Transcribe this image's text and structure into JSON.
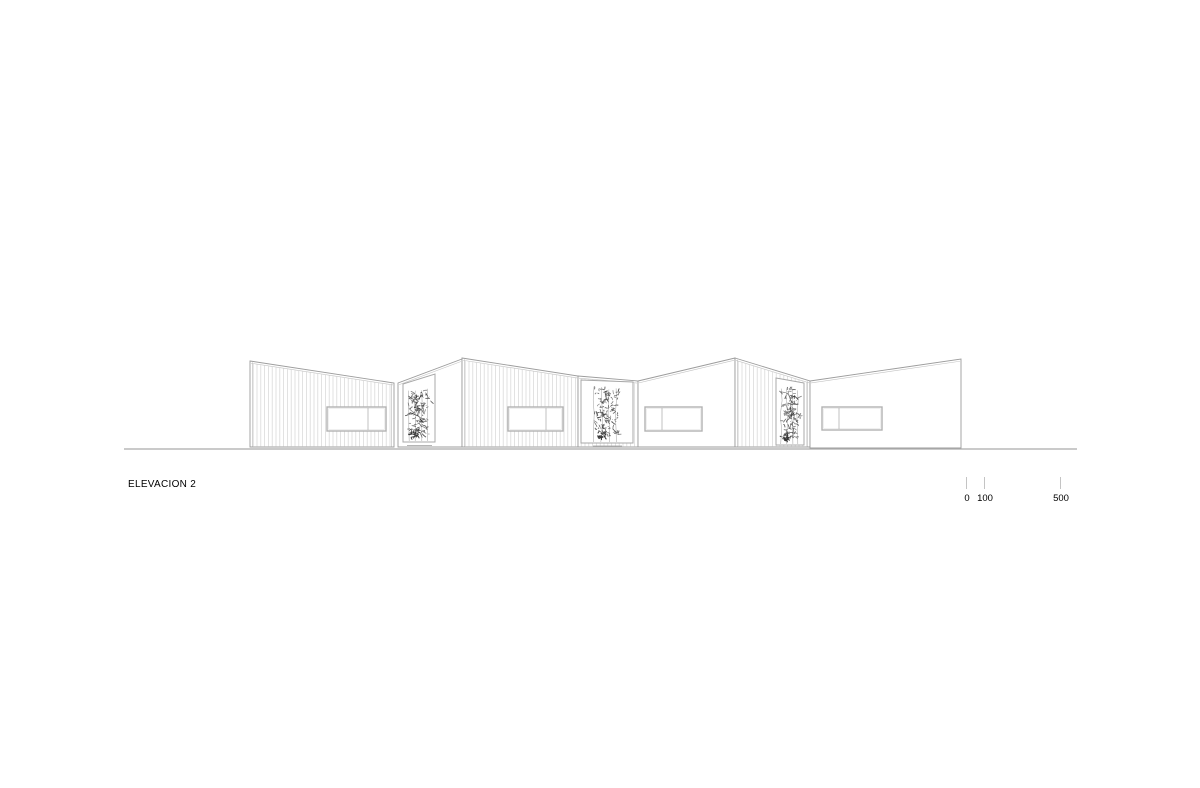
{
  "title": {
    "text": "ELEVACION 2"
  },
  "scale_bar": {
    "ticks": [
      {
        "x": 966,
        "label": "0"
      },
      {
        "x": 984,
        "label": "100"
      },
      {
        "x": 1060,
        "label": "500"
      }
    ],
    "tick_top": 477,
    "tick_height": 12,
    "label_top": 493
  },
  "colors": {
    "background": "#ffffff",
    "outline": "#9c9c9c",
    "outline_light": "#c2c2c2",
    "hatch": "#d8d8d8",
    "ground": "#ababab",
    "window_stroke": "#b2b2b2",
    "frame_stroke": "#a8a8a8",
    "plant_dark": "#353535",
    "plant_mid": "#5c5c5c",
    "plant_stem": "#a6a6a6",
    "text": "#000000"
  },
  "drawing": {
    "ground": {
      "x1": 124,
      "x2": 1077,
      "y": 449
    },
    "facades": [
      {
        "name": "facade-module-a",
        "pts": [
          [
            250,
            361
          ],
          [
            394,
            383
          ],
          [
            394,
            447
          ],
          [
            250,
            447
          ]
        ],
        "hatch": true,
        "trims": [
          "left",
          "right"
        ]
      },
      {
        "name": "facade-bay-a-wall",
        "pts": [
          [
            398,
            383
          ],
          [
            462,
            359
          ],
          [
            462,
            447
          ],
          [
            398,
            447
          ]
        ],
        "hatch": false,
        "trims": []
      },
      {
        "name": "facade-module-b",
        "pts": [
          [
            462,
            358
          ],
          [
            578,
            376
          ],
          [
            578,
            447
          ],
          [
            462,
            447
          ]
        ],
        "hatch": true,
        "trims": [
          "left"
        ]
      },
      {
        "name": "facade-bay-b-wall",
        "pts": [
          [
            578,
            376
          ],
          [
            638,
            381
          ],
          [
            638,
            447
          ],
          [
            578,
            447
          ]
        ],
        "hatch": true,
        "trims": []
      },
      {
        "name": "facade-module-c",
        "pts": [
          [
            638,
            381
          ],
          [
            735,
            358
          ],
          [
            735,
            447
          ],
          [
            638,
            447
          ]
        ],
        "hatch": false,
        "trims": []
      },
      {
        "name": "facade-module-c-hatch",
        "pts": [
          [
            735,
            358
          ],
          [
            810,
            381
          ],
          [
            810,
            447
          ],
          [
            735,
            447
          ]
        ],
        "hatch": true,
        "trims": [
          "left",
          "right"
        ]
      },
      {
        "name": "facade-module-d",
        "pts": [
          [
            810,
            381
          ],
          [
            961,
            359
          ],
          [
            961,
            448
          ],
          [
            810,
            448
          ]
        ],
        "hatch": false,
        "trims": []
      }
    ],
    "windows": [
      {
        "x": 327,
        "y": 407,
        "w": 59,
        "h": 24,
        "divider_x": 368
      },
      {
        "x": 508,
        "y": 407,
        "w": 55,
        "h": 24,
        "divider_x": 546
      },
      {
        "x": 645,
        "y": 407,
        "w": 57,
        "h": 24,
        "divider_x": 662
      },
      {
        "x": 822,
        "y": 407,
        "w": 60,
        "h": 23,
        "divider_x": 839
      }
    ],
    "plant_frames": [
      {
        "pts": [
          [
            403,
            384
          ],
          [
            435,
            374
          ],
          [
            435,
            442
          ],
          [
            403,
            442
          ]
        ]
      },
      {
        "pts": [
          [
            581,
            380
          ],
          [
            633,
            382
          ],
          [
            633,
            443
          ],
          [
            581,
            443
          ]
        ]
      },
      {
        "pts": [
          [
            776,
            378
          ],
          [
            804,
            383
          ],
          [
            804,
            445
          ],
          [
            776,
            445
          ]
        ]
      }
    ],
    "plants": [
      {
        "cx": 419,
        "top": 388,
        "bottom": 441,
        "halfw": 13,
        "seed": 11
      },
      {
        "cx": 606,
        "top": 386,
        "bottom": 442,
        "halfw": 15,
        "seed": 23
      },
      {
        "cx": 790,
        "top": 386,
        "bottom": 444,
        "halfw": 11,
        "seed": 37
      }
    ],
    "base_marks": [
      {
        "x1": 407,
        "x2": 432,
        "y": 445.5
      },
      {
        "x1": 593,
        "x2": 622,
        "y": 446
      },
      {
        "x1": 779,
        "x2": 801,
        "y": 447
      }
    ]
  }
}
